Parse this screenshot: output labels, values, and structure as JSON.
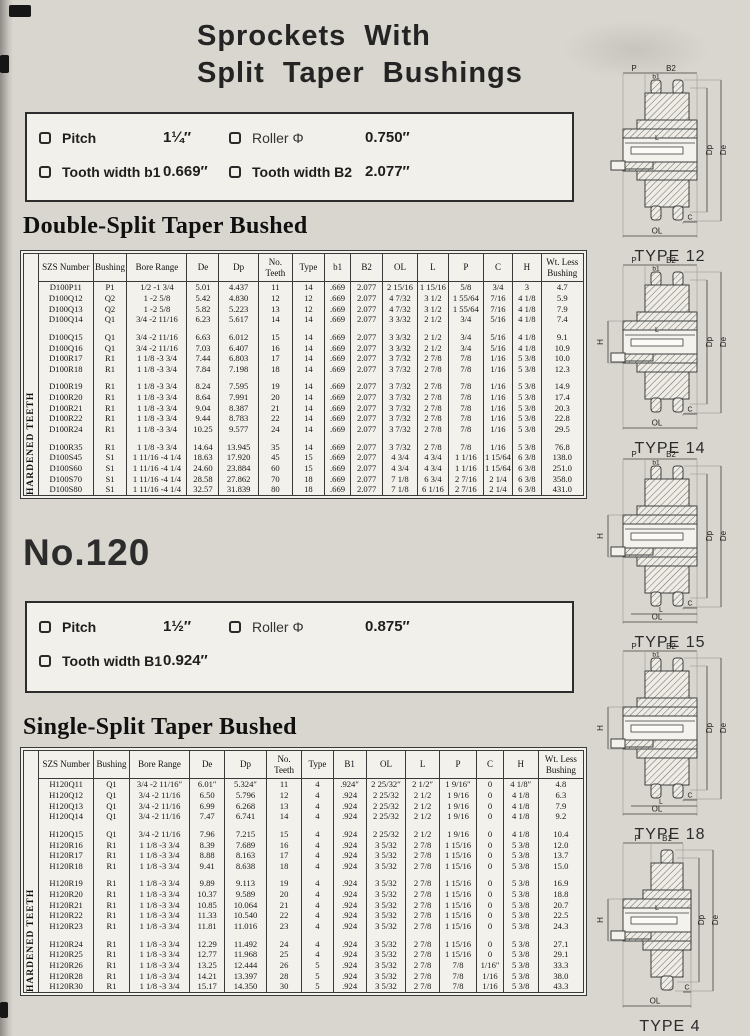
{
  "page": {
    "title_line1": "Sprockets With",
    "title_line2": "Split Taper Bushings",
    "series_heading": "No.120"
  },
  "spec_box_100": {
    "items": [
      {
        "label": "Pitch",
        "value": "1¼″"
      },
      {
        "label": "Roller Φ",
        "value": "0.750″"
      },
      {
        "label": "Tooth width b1",
        "value": "0.669″"
      },
      {
        "label": "Tooth width B2",
        "value": "2.077″"
      }
    ]
  },
  "spec_box_120": {
    "items": [
      {
        "label": "Pitch",
        "value": "1½″"
      },
      {
        "label": "Roller Φ",
        "value": "0.875″"
      },
      {
        "label": "Tooth width B1",
        "value": "0.924″"
      }
    ]
  },
  "table1": {
    "heading": "Double-Split Taper Bushed",
    "side_label": "HARDENED TEETH",
    "columns": [
      "SZS Number",
      "Bushing",
      "Bore Range",
      "De",
      "Dp",
      "No. Teeth",
      "Type",
      "b1",
      "B2",
      "OL",
      "L",
      "P",
      "C",
      "H",
      "Wt. Less Bushing"
    ],
    "groups": [
      [
        [
          "D100P11",
          "P1",
          "1/2 -1 3/4",
          "5.01",
          "4.437",
          "11",
          "14",
          ".669",
          "2.077",
          "2 15/16",
          "1 15/16",
          "5/8",
          "3/4",
          "3",
          "4.7"
        ],
        [
          "D100Q12",
          "Q2",
          "1 -2 5/8",
          "5.42",
          "4.830",
          "12",
          "12",
          ".669",
          "2.077",
          "4 7/32",
          "3 1/2",
          "1 55/64",
          "7/16",
          "4 1/8",
          "5.9"
        ],
        [
          "D100Q13",
          "Q2",
          "1 -2 5/8",
          "5.82",
          "5.223",
          "13",
          "12",
          ".669",
          "2.077",
          "4 7/32",
          "3 1/2",
          "1 55/64",
          "7/16",
          "4 1/8",
          "7.9"
        ],
        [
          "D100Q14",
          "Q1",
          "3/4 -2 11/16",
          "6.23",
          "5.617",
          "14",
          "14",
          ".669",
          "2.077",
          "3 3/32",
          "2 1/2",
          "3/4",
          "5/16",
          "4 1/8",
          "7.4"
        ]
      ],
      [
        [
          "D100Q15",
          "Q1",
          "3/4 -2 11/16",
          "6.63",
          "6.012",
          "15",
          "14",
          ".669",
          "2.077",
          "3 3/32",
          "2 1/2",
          "3/4",
          "5/16",
          "4 1/8",
          "9.1"
        ],
        [
          "D100Q16",
          "Q1",
          "3/4 -2 11/16",
          "7.03",
          "6.407",
          "16",
          "14",
          ".669",
          "2.077",
          "3 3/32",
          "2 1/2",
          "3/4",
          "5/16",
          "4 1/8",
          "10.9"
        ],
        [
          "D100R17",
          "R1",
          "1 1/8 -3 3/4",
          "7.44",
          "6.803",
          "17",
          "14",
          ".669",
          "2.077",
          "3 7/32",
          "2 7/8",
          "7/8",
          "1/16",
          "5 3/8",
          "10.0"
        ],
        [
          "D100R18",
          "R1",
          "1 1/8 -3 3/4",
          "7.84",
          "7.198",
          "18",
          "14",
          ".669",
          "2.077",
          "3 7/32",
          "2 7/8",
          "7/8",
          "1/16",
          "5 3/8",
          "12.3"
        ]
      ],
      [
        [
          "D100R19",
          "R1",
          "1 1/8 -3 3/4",
          "8.24",
          "7.595",
          "19",
          "14",
          ".669",
          "2.077",
          "3 7/32",
          "2 7/8",
          "7/8",
          "1/16",
          "5 3/8",
          "14.9"
        ],
        [
          "D100R20",
          "R1",
          "1 1/8 -3 3/4",
          "8.64",
          "7.991",
          "20",
          "14",
          ".669",
          "2.077",
          "3 7/32",
          "2 7/8",
          "7/8",
          "1/16",
          "5 3/8",
          "17.4"
        ],
        [
          "D100R21",
          "R1",
          "1 1/8 -3 3/4",
          "9.04",
          "8.387",
          "21",
          "14",
          ".669",
          "2.077",
          "3 7/32",
          "2 7/8",
          "7/8",
          "1/16",
          "5 3/8",
          "20.3"
        ],
        [
          "D100R22",
          "R1",
          "1 1/8 -3 3/4",
          "9.44",
          "8.783",
          "22",
          "14",
          ".669",
          "2.077",
          "3 7/32",
          "2 7/8",
          "7/8",
          "1/16",
          "5 3/8",
          "22.8"
        ],
        [
          "D100R24",
          "R1",
          "1 1/8 -3 3/4",
          "10.25",
          "9.577",
          "24",
          "14",
          ".669",
          "2.077",
          "3 7/32",
          "2 7/8",
          "7/8",
          "1/16",
          "5 3/8",
          "29.5"
        ]
      ],
      [
        [
          "D100R35",
          "R1",
          "1 1/8 -3 3/4",
          "14.64",
          "13.945",
          "35",
          "14",
          ".669",
          "2.077",
          "3 7/32",
          "2 7/8",
          "7/8",
          "1/16",
          "5 3/8",
          "76.8"
        ],
        [
          "D100S45",
          "S1",
          "1 11/16 -4 1/4",
          "18.63",
          "17.920",
          "45",
          "15",
          ".669",
          "2.077",
          "4 3/4",
          "4 3/4",
          "1 1/16",
          "1 15/64",
          "6 3/8",
          "138.0"
        ],
        [
          "D100S60",
          "S1",
          "1 11/16 -4 1/4",
          "24.60",
          "23.884",
          "60",
          "15",
          ".669",
          "2.077",
          "4 3/4",
          "4 3/4",
          "1 1/16",
          "1 15/64",
          "6 3/8",
          "251.0"
        ],
        [
          "D100S70",
          "S1",
          "1 11/16 -4 1/4",
          "28.58",
          "27.862",
          "70",
          "18",
          ".669",
          "2.077",
          "7 1/8",
          "6 3/4",
          "2 7/16",
          "2 1/4",
          "6 3/8",
          "358.0"
        ],
        [
          "D100S80",
          "S1",
          "1 11/16 -4 1/4",
          "32.57",
          "31.839",
          "80",
          "18",
          ".669",
          "2.077",
          "7 1/8",
          "6 1/16",
          "2 7/16",
          "2 1/4",
          "6 3/8",
          "431.0"
        ]
      ]
    ]
  },
  "table2": {
    "heading": "Single-Split Taper Bushed",
    "side_label": "HARDENED TEETH",
    "columns": [
      "SZS Number",
      "Bushing",
      "Bore Range",
      "De",
      "Dp",
      "No. Teeth",
      "Type",
      "B1",
      "OL",
      "L",
      "P",
      "C",
      "H",
      "Wt. Less Bushing"
    ],
    "groups": [
      [
        [
          "H120Q11",
          "Q1",
          "3/4 -2 11/16″",
          "6.01″",
          "5.324″",
          "11",
          "4",
          ".924″",
          "2 25/32″",
          "2 1/2″",
          "1 9/16″",
          "0",
          "4 1/8″",
          "4.8"
        ],
        [
          "H120Q12",
          "Q1",
          "3/4 -2 11/16",
          "6.50",
          "5.796",
          "12",
          "4",
          ".924",
          "2 25/32",
          "2 1/2",
          "1 9/16",
          "0",
          "4 1/8",
          "6.3"
        ],
        [
          "H120Q13",
          "Q1",
          "3/4 -2 11/16",
          "6.99",
          "6.268",
          "13",
          "4",
          ".924",
          "2 25/32",
          "2 1/2",
          "1 9/16",
          "0",
          "4 1/8",
          "7.9"
        ],
        [
          "H120Q14",
          "Q1",
          "3/4 -2 11/16",
          "7.47",
          "6.741",
          "14",
          "4",
          ".924",
          "2 25/32",
          "2 1/2",
          "1 9/16",
          "0",
          "4 1/8",
          "9.2"
        ]
      ],
      [
        [
          "H120Q15",
          "Q1",
          "3/4 -2 11/16",
          "7.96",
          "7.215",
          "15",
          "4",
          ".924",
          "2 25/32",
          "2 1/2",
          "1 9/16",
          "0",
          "4 1/8",
          "10.4"
        ],
        [
          "H120R16",
          "R1",
          "1 1/8 -3 3/4",
          "8.39",
          "7.689",
          "16",
          "4",
          ".924",
          "3 5/32",
          "2 7/8",
          "1 15/16",
          "0",
          "5 3/8",
          "12.0"
        ],
        [
          "H120R17",
          "R1",
          "1 1/8 -3 3/4",
          "8.88",
          "8.163",
          "17",
          "4",
          ".924",
          "3 5/32",
          "2 7/8",
          "1 15/16",
          "0",
          "5 3/8",
          "13.7"
        ],
        [
          "H120R18",
          "R1",
          "1 1/8 -3 3/4",
          "9.41",
          "8.638",
          "18",
          "4",
          ".924",
          "3 5/32",
          "2 7/8",
          "1 15/16",
          "0",
          "5 3/8",
          "15.0"
        ]
      ],
      [
        [
          "H120R19",
          "R1",
          "1 1/8 -3 3/4",
          "9.89",
          "9.113",
          "19",
          "4",
          ".924",
          "3 5/32",
          "2 7/8",
          "1 15/16",
          "0",
          "5 3/8",
          "16.9"
        ],
        [
          "H120R20",
          "R1",
          "1 1/8 -3 3/4",
          "10.37",
          "9.589",
          "20",
          "4",
          ".924",
          "3 5/32",
          "2 7/8",
          "1 15/16",
          "0",
          "5 3/8",
          "18.8"
        ],
        [
          "H120R21",
          "R1",
          "1 1/8 -3 3/4",
          "10.85",
          "10.064",
          "21",
          "4",
          ".924",
          "3 5/32",
          "2 7/8",
          "1 15/16",
          "0",
          "5 3/8",
          "20.7"
        ],
        [
          "H120R22",
          "R1",
          "1 1/8 -3 3/4",
          "11.33",
          "10.540",
          "22",
          "4",
          ".924",
          "3 5/32",
          "2 7/8",
          "1 15/16",
          "0",
          "5 3/8",
          "22.5"
        ],
        [
          "H120R23",
          "R1",
          "1 1/8 -3 3/4",
          "11.81",
          "11.016",
          "23",
          "4",
          ".924",
          "3 5/32",
          "2 7/8",
          "1 15/16",
          "0",
          "5 3/8",
          "24.3"
        ]
      ],
      [
        [
          "H120R24",
          "R1",
          "1 1/8 -3 3/4",
          "12.29",
          "11.492",
          "24",
          "4",
          ".924",
          "3 5/32",
          "2 7/8",
          "1 15/16",
          "0",
          "5 3/8",
          "27.1"
        ],
        [
          "H120R25",
          "R1",
          "1 1/8 -3 3/4",
          "12.77",
          "11.968",
          "25",
          "4",
          ".924",
          "3 5/32",
          "2 7/8",
          "1 15/16",
          "0",
          "5 3/8",
          "29.1"
        ],
        [
          "H120R26",
          "R1",
          "1 1/8 -3 3/4",
          "13.25",
          "12.444",
          "26",
          "5",
          ".924",
          "3 5/32",
          "2 7/8",
          "7/8",
          "1/16″",
          "5 3/8",
          "33.3"
        ],
        [
          "H120R28",
          "R1",
          "1 1/8 -3 3/4",
          "14.21",
          "13.397",
          "28",
          "5",
          ".924",
          "3 5/32",
          "2 7/8",
          "7/8",
          "1/16",
          "5 3/8",
          "38.0"
        ],
        [
          "H120R30",
          "R1",
          "1 1/8 -3 3/4",
          "15.17",
          "14.350",
          "30",
          "5",
          ".924",
          "3 5/32",
          "2 7/8",
          "7/8",
          "1/16",
          "5 3/8",
          "43.3"
        ]
      ]
    ]
  },
  "diagrams": [
    {
      "caption": "TYPE 12",
      "labels": {
        "p": "P",
        "b_outer": "B2",
        "b_inner": "b1",
        "l": "L",
        "dp": "Dp",
        "de": "De",
        "c": "C",
        "ol": "OL"
      }
    },
    {
      "caption": "TYPE 14",
      "labels": {
        "p": "P",
        "b_outer": "B2",
        "b_inner": "b1",
        "h": "H",
        "l": "L",
        "dp": "Dp",
        "de": "De",
        "c": "C",
        "ol": "OL"
      }
    },
    {
      "caption": "TYPE 15",
      "labels": {
        "p": "P",
        "b_outer": "B2",
        "b_inner": "b1",
        "h": "H",
        "l": "L",
        "dp": "Dp",
        "de": "De",
        "c": "C",
        "ol": "OL"
      }
    },
    {
      "caption": "TYPE 18",
      "labels": {
        "p": "P",
        "b_outer": "B2",
        "b_inner": "b1",
        "h": "H",
        "l": "L",
        "dp": "Dp",
        "de": "De",
        "c": "C",
        "ol": "OL"
      }
    },
    {
      "caption": "TYPE 4",
      "labels": {
        "p": "P",
        "b_outer": "B1",
        "h": "H",
        "l": "L",
        "dp": "Dp",
        "de": "De",
        "c": "C",
        "ol": "OL"
      }
    }
  ]
}
